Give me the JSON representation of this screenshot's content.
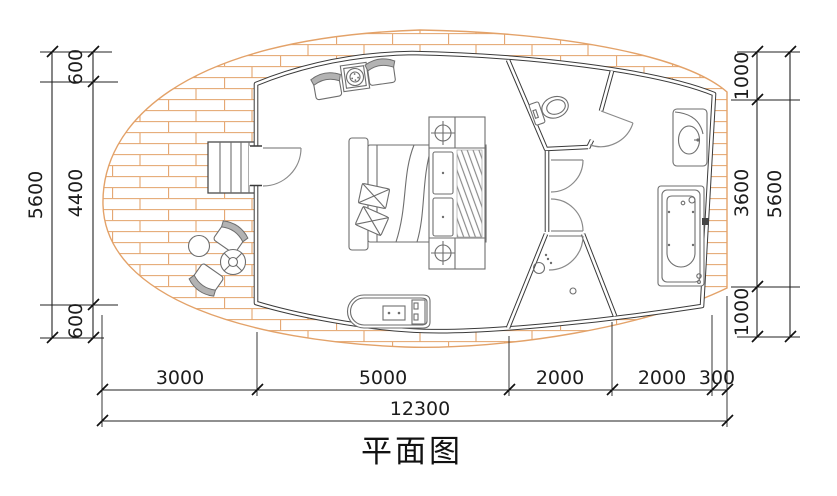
{
  "title": "平面图",
  "dimensions": {
    "left": {
      "overall": "5600",
      "segments": [
        "600",
        "4400",
        "600"
      ]
    },
    "right": {
      "overall": "5600",
      "segments": [
        "1000",
        "3600",
        "1000"
      ]
    },
    "bottom": {
      "overall": "12300",
      "segments": [
        "3000",
        "5000",
        "2000",
        "2000",
        "300"
      ]
    }
  },
  "fixtures": [
    "entry-stairs",
    "entry-door",
    "lounge-chair",
    "side-table",
    "round-table",
    "planter",
    "double-bed",
    "wardrobe",
    "kitchenette-counter",
    "toilet",
    "washbasin-vanity",
    "bathtub",
    "shower-area",
    "interior-doors",
    "brick-terrace"
  ],
  "colors": {
    "brick": "#E3A269",
    "wall": "#3A3A3A",
    "furniture": "#6E6E6E",
    "dimension": "#222222",
    "background": "#FFFFFF"
  }
}
